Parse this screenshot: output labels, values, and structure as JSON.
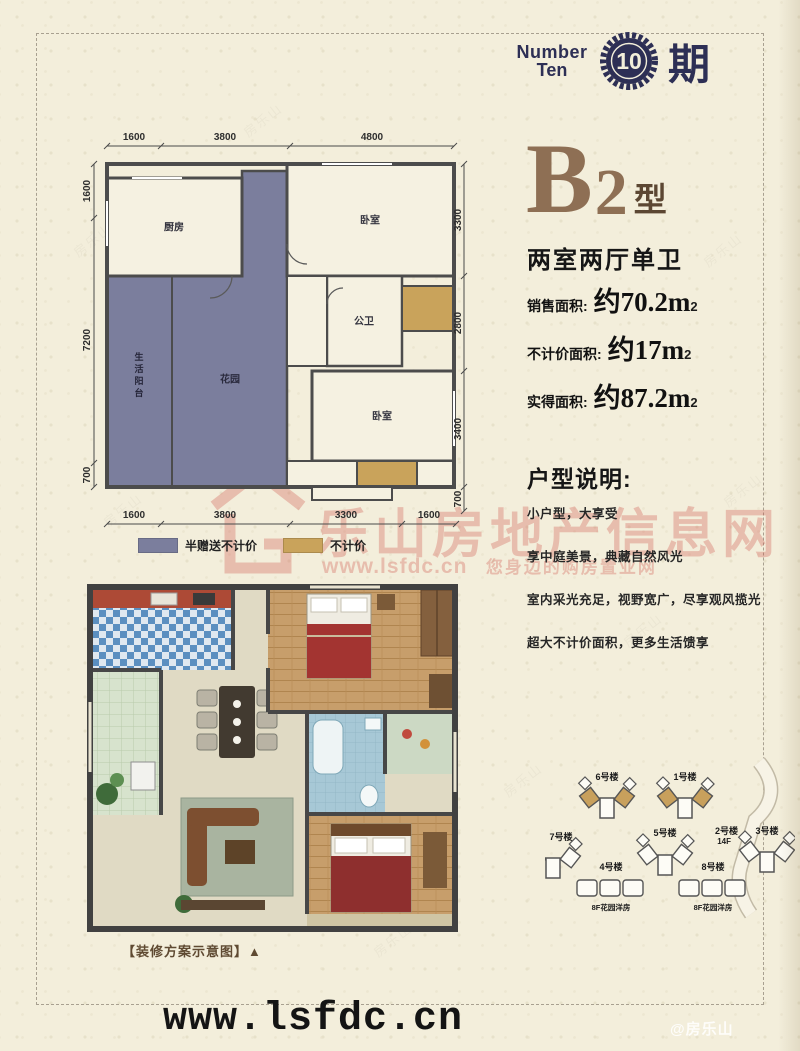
{
  "logo": {
    "word1": "Number",
    "word2": "Ten",
    "badge": "10",
    "suffix": "期"
  },
  "unit": {
    "letter": "B",
    "number": "2",
    "suffix": "型",
    "layout": "两室两厅单卫",
    "areas": [
      {
        "label": "销售面积:",
        "value": "约70.2m",
        "sup": "2"
      },
      {
        "label": "不计价面积:",
        "value": "约17m",
        "sup": "2"
      },
      {
        "label": "实得面积:",
        "value": "约87.2m",
        "sup": "2"
      }
    ]
  },
  "description": {
    "title": "户型说明:",
    "lines": [
      "小户型，大享受",
      "享中庭美景，典藏自然风光",
      "室内采光充足，视野宽广，尽享观风揽光",
      "超大不计价面积，更多生活馈享"
    ]
  },
  "floorplan": {
    "dims_top": [
      "1600",
      "3800",
      "4800"
    ],
    "dims_bottom": [
      "1600",
      "3800",
      "3300",
      "1600"
    ],
    "dims_left": [
      "1600",
      "7200",
      "700"
    ],
    "dims_right": [
      "3300",
      "2800",
      "3400",
      "700"
    ],
    "rooms": {
      "kitchen": "厨房",
      "bedroom_top": "卧室",
      "bath": "公卫",
      "bedroom_low": "卧室",
      "garden": "花园",
      "service_balcony": "生活阳台"
    },
    "legend": [
      {
        "label": "半赠送不计价",
        "color": "#7b7e9d"
      },
      {
        "label": "不计价",
        "color": "#c9a35b"
      }
    ]
  },
  "render_plan": {
    "caption": "【装修方案示意图】▲"
  },
  "siteplan": {
    "b1": "6号楼",
    "b2": "1号楼",
    "road": "2号楼",
    "road_sub": "14F",
    "b3": "7号楼",
    "b4": "4号楼",
    "b5": "5号楼",
    "b6": "8号楼",
    "b7": "3号楼",
    "cap1": "8F花园洋房",
    "cap2": "8F花园洋房"
  },
  "watermark": {
    "brand": "乐山房地产信息网",
    "sub_url": "www.lsfdc.cn",
    "sub_text": "您身边的购房置业网",
    "corner": "@房乐山",
    "tile": "房乐山"
  },
  "footer": {
    "url": "www.lsfdc.cn"
  },
  "colors": {
    "accent_navy": "#2d2f55",
    "accent_brown": "#8e6f54",
    "purple": "#7b7e9d",
    "gold": "#c9a35b",
    "watermark_red": "#d2564b"
  }
}
